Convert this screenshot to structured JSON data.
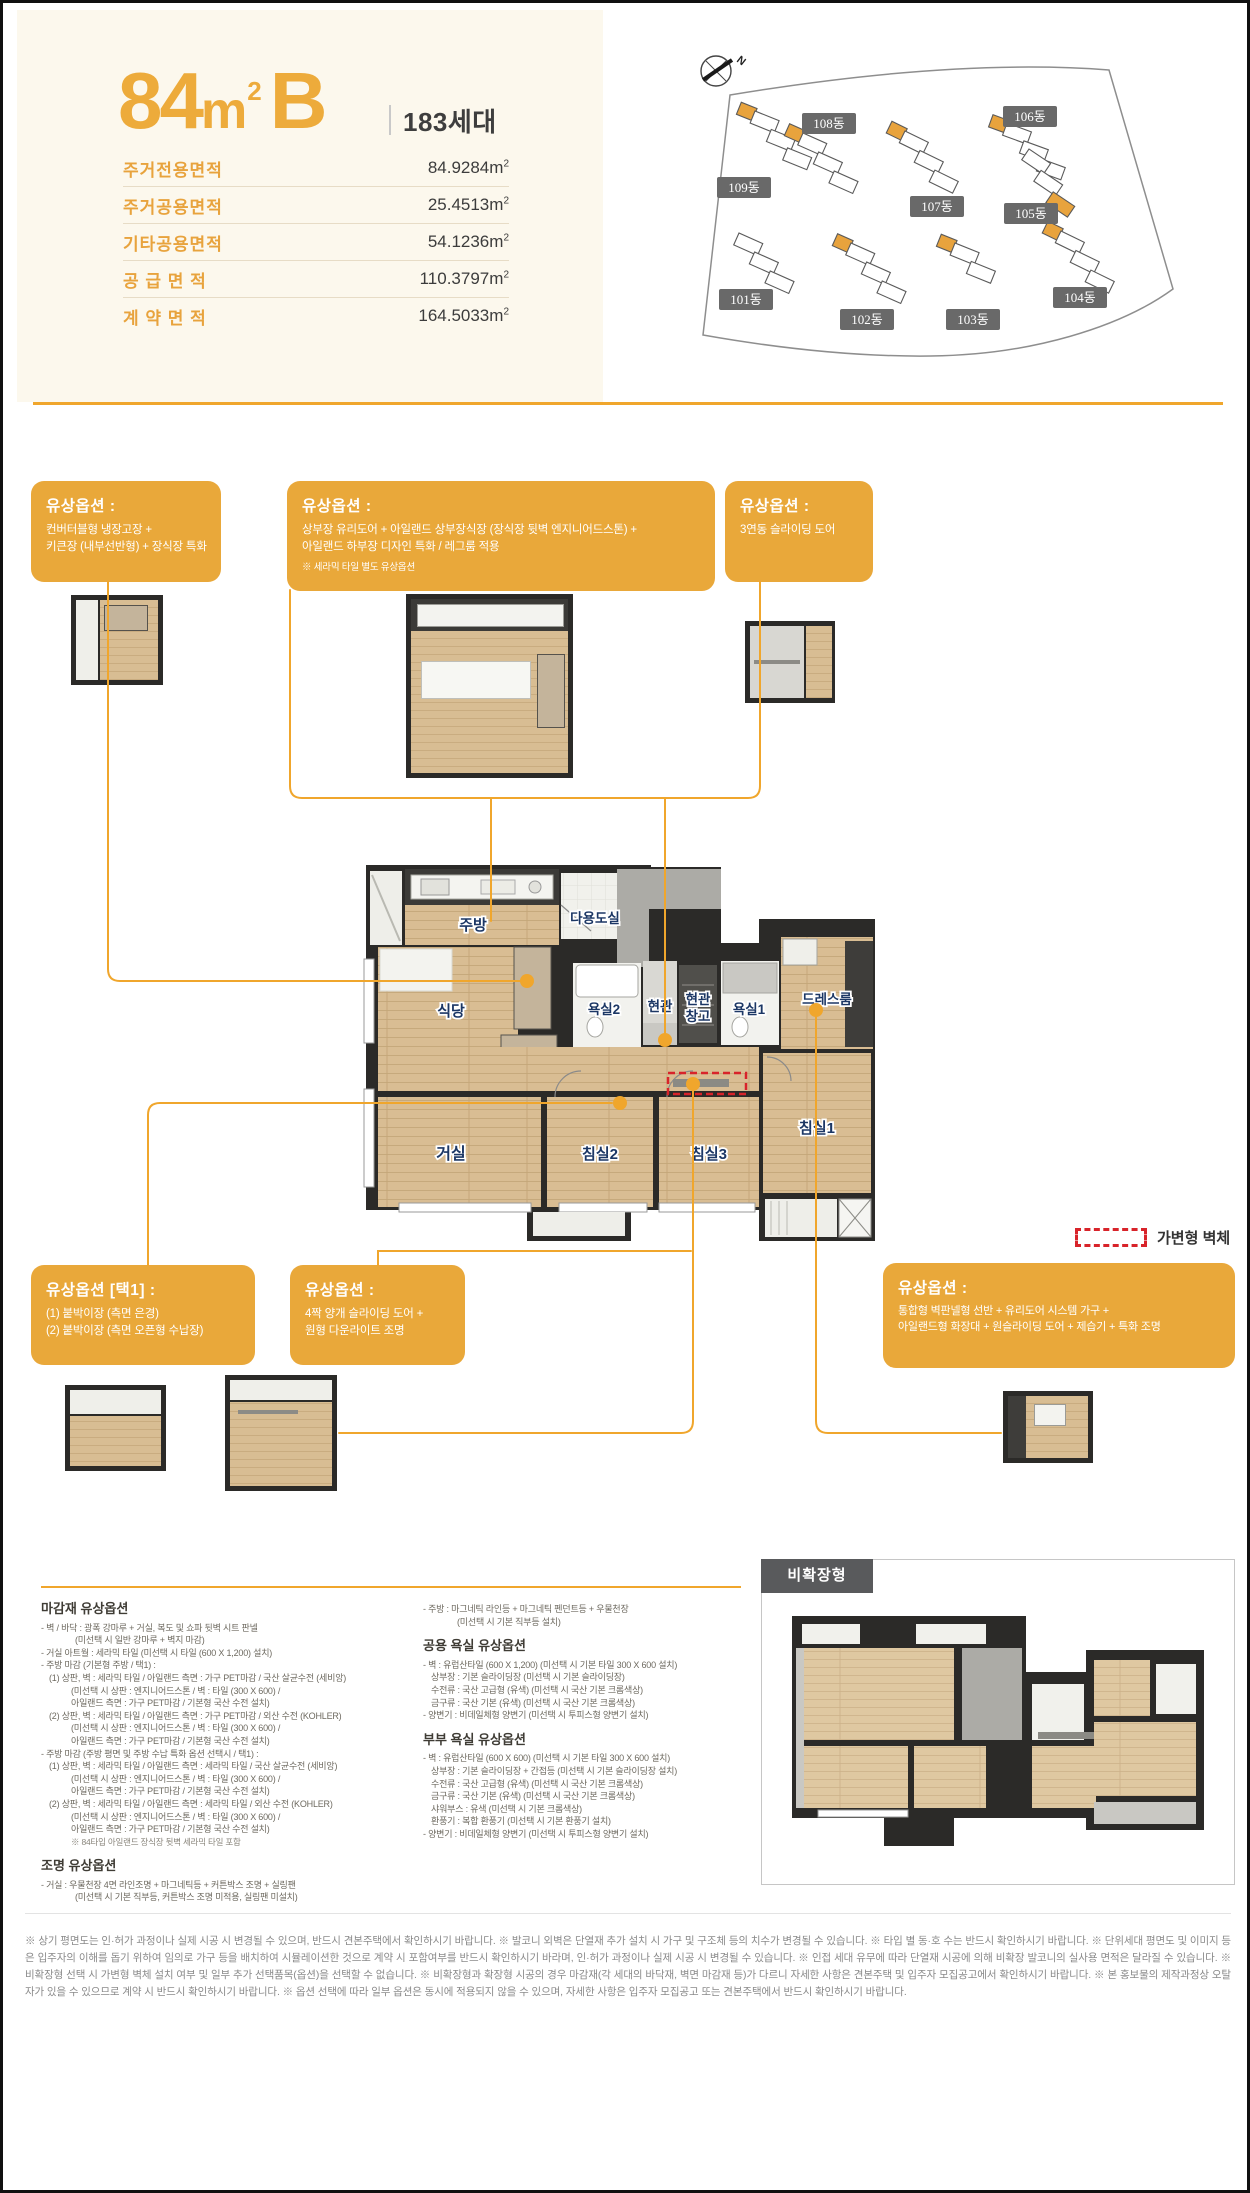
{
  "colors": {
    "accent": "#E9A83A",
    "cream": "#FCF8ED",
    "connector": "#F0A62C",
    "label_navy": "#1C3765",
    "movable_wall_red": "#D8232A"
  },
  "header": {
    "type": {
      "num": "84",
      "unit_base": "m",
      "unit_sup": "2",
      "variant": "B"
    },
    "households": "183세대",
    "unit": {
      "base": "m",
      "sup": "2"
    },
    "rows": [
      {
        "label": "주거전용면적",
        "num": "84.9284"
      },
      {
        "label": "주거공용면적",
        "num": "25.4513"
      },
      {
        "label": "기타공용면적",
        "num": "54.1236"
      },
      {
        "label": "공 급 면 적",
        "num": "110.3797"
      },
      {
        "label": "계 약 면 적",
        "num": "164.5033"
      }
    ]
  },
  "map": {
    "north": "N",
    "badges": [
      "101동",
      "102동",
      "103동",
      "104동",
      "105동",
      "106동",
      "107동",
      "108동",
      "109동"
    ]
  },
  "opt_top": [
    {
      "title": "유상옵션 :",
      "line1": "컨버터블형 냉장고장 +",
      "line2": "키큰장 (내부선반형) + 장식장 특화",
      "note": ""
    },
    {
      "title": "유상옵션 :",
      "line1": "상부장 유리도어 + 아일랜드 상부장식장 (장식장 뒷벽 엔지니어드스톤) +",
      "line2": "아일랜드 하부장 디자인 특화 / 레그룸 적용",
      "note": "※ 세라믹 타일 별도 유상옵션"
    },
    {
      "title": "유상옵션 :",
      "line1": "3연동 슬라이딩 도어",
      "line2": "",
      "note": ""
    }
  ],
  "opt_bottom": [
    {
      "title": "유상옵션 [택1] :",
      "line1": "(1) 붙박이장 (측면 은경)",
      "line2": "(2) 붙박이장 (측면 오픈형 수납장)"
    },
    {
      "title": "유상옵션 :",
      "line1": "4짝 양개 슬라이딩 도어 +",
      "line2": "원형 다운라이트 조명"
    },
    {
      "title": "유상옵션 :",
      "line1": "통합형 벽판넬형 선반 + 유리도어 시스템 가구 +",
      "line2": "아일랜드형 화장대 + 원슬라이딩 도어 + 제습기 + 특화 조명"
    }
  ],
  "plan": {
    "rooms": {
      "kitchen": "주방",
      "utility": "다용도실",
      "dining": "식당",
      "bath2": "욕실2",
      "entry": "현관",
      "entry_storage": [
        "현관",
        "창고"
      ],
      "bath1": "욕실1",
      "dressroom": "드레스룸",
      "living": "거실",
      "bed2": "침실2",
      "bed3": "침실3",
      "bed1": "침실1"
    }
  },
  "legend": {
    "movable_wall": "가변형 벽체"
  },
  "panel": {
    "label": "비확장형"
  },
  "specs": {
    "finish": {
      "title": "마감재 유상옵션",
      "lines": [
        "- 벽 / 바닥 : 광폭 강마루 + 거실, 복도 및 쇼파 뒷벽 시트 판넬",
        "(미선택 시 일반 강마루 + 벽지 마감)",
        "- 거실 아트월 : 세라믹 타일 (미선택 시 타일 (600 X 1,200) 설치)",
        "- 주방 마감 (기본형 주방 / 택1) :",
        "(1) 상판, 벽 : 세라믹 타일 / 아일랜드 측면 : 가구 PET마감 / 국산 살균수전 (세비앙)",
        "(미선택 시 상판 : 엔지니어드스톤 / 벽 : 타일 (300 X 600) /",
        "아일랜드 측면 : 가구 PET마감 / 기본형 국산 수전 설치)",
        "(2) 상판, 벽 : 세라믹 타일 / 아일랜드 측면 : 가구 PET마감 / 외산 수전 (KOHLER)",
        "(미선택 시 상판 : 엔지니어드스톤 / 벽 : 타일 (300 X 600) /",
        "아일랜드 측면 : 가구 PET마감 / 기본형 국산 수전 설치)",
        "- 주방 마감 (주방 평면 및 주방 수납 특화 옵션 선택시 / 택1) :",
        "(1) 상판, 벽 : 세라믹 타일 / 아일랜드 측면 : 세라믹 타일 / 국산 살균수전 (세비앙)",
        "(미선택 시 상판 : 엔지니어드스톤 / 벽 : 타일 (300 X 600) /",
        "아일랜드 측면 : 가구 PET마감 / 기본형 국산 수전 설치)",
        "(2) 상판, 벽 : 세라믹 타일 / 아일랜드 측면 : 세라믹 타일 / 외산 수전 (KOHLER)",
        "(미선택 시 상판 : 엔지니어드스톤 / 벽 : 타일 (300 X 600) /",
        "아일랜드 측면 : 가구 PET마감 / 기본형 국산 수전 설치)",
        "※ 84타입 아일랜드 장식장 뒷벽 세라믹 타일 포함"
      ]
    },
    "lighting": {
      "title": "조명 유상옵션",
      "lines": [
        "- 거실 : 우물천장 4면 라인조명 + 마그네틱등 + 커튼박스 조명 + 실링팬",
        "(미선택 시 기본 직부등, 커튼박스 조명 미적용, 실링팬 미설치)"
      ]
    },
    "kitchen_light": {
      "lines": [
        "- 주방 : 마그네틱 라인등 + 마그네틱 펜던트등 + 우물천장",
        "(미선택 시 기본 직부등 설치)"
      ]
    },
    "common_bath": {
      "title": "공용 욕실 유상옵션",
      "lines": [
        "- 벽 : 유럽산타일 (600 X 1,200) (미선택 시 기본 타일 300 X 600 설치)",
        "상부장 : 기본 슬라이딩장 (미선택 시 기본 슬라이딩장)",
        "수전류 : 국산 고급형 (유색) (미선택 시 국산 기본 크롬색상)",
        "금구류 : 국산 기본 (유색) (미선택 시 국산 기본 크롬색상)",
        "- 양변기 : 비데일체형 양변기 (미선택 시 투피스형 양변기 설치)"
      ]
    },
    "master_bath": {
      "title": "부부 욕실 유상옵션",
      "lines": [
        "- 벽 : 유럽산타일 (600 X 600) (미선택 시 기본 타일 300 X 600 설치)",
        "상부장 : 기본 슬라이딩장 + 간접등 (미선택 시 기본 슬라이딩장 설치)",
        "수전류 : 국산 고급형 (유색) (미선택 시 국산 기본 크롬색상)",
        "금구류 : 국산 기본 (유색) (미선택 시 국산 기본 크롬색상)",
        "샤워부스 : 유색 (미선택 시 기본 크롬색상)",
        "환풍기 : 복합 환풍기 (미선택 시 기본 환풍기 설치)",
        "- 양변기 : 비데일체형 양변기 (미선택 시 투피스형 양변기 설치)"
      ]
    }
  },
  "footer": {
    "text": "※ 상기 평면도는 인·허가 과정이나 실제 시공 시 변경될 수 있으며, 반드시 견본주택에서 확인하시기 바랍니다. ※ 발코니 외벽은 단열재 추가 설치 시 가구 및 구조체 등의 치수가 변경될 수 있습니다. ※ 타입 별 동·호 수는 반드시 확인하시기 바랍니다. ※ 단위세대 평면도 및 이미지 등은 입주자의 이해를 돕기 위하여 임의로 가구 등을 배치하여 시뮬레이션한 것으로 계약 시 포함여부를 반드시 확인하시기 바라며, 인·허가 과정이나 실제 시공 시 변경될 수 있습니다. ※ 인접 세대 유무에 따라 단열재 시공에 의해 비확장 발코니의 실사용 면적은 달라질 수 있습니다. ※ 비확장형 선택 시 가변형 벽체 설치 여부 및 일부 추가 선택품목(옵션)을 선택할 수 없습니다. ※ 비확장형과 확장형 시공의 경우 마감재(각 세대의 바닥재, 벽면 마감재 등)가 다르니 자세한 사항은 견본주택 및 입주자 모집공고에서 확인하시기 바랍니다. ※ 본 홍보물의 제작과정상 오탈자가 있을 수 있으므로 계약 시 반드시 확인하시기 바랍니다. ※ 옵션 선택에 따라 일부 옵션은 동시에 적용되지 않을 수 있으며, 자세한 사항은 입주자 모집공고 또는 견본주택에서 반드시 확인하시기 바랍니다."
  }
}
